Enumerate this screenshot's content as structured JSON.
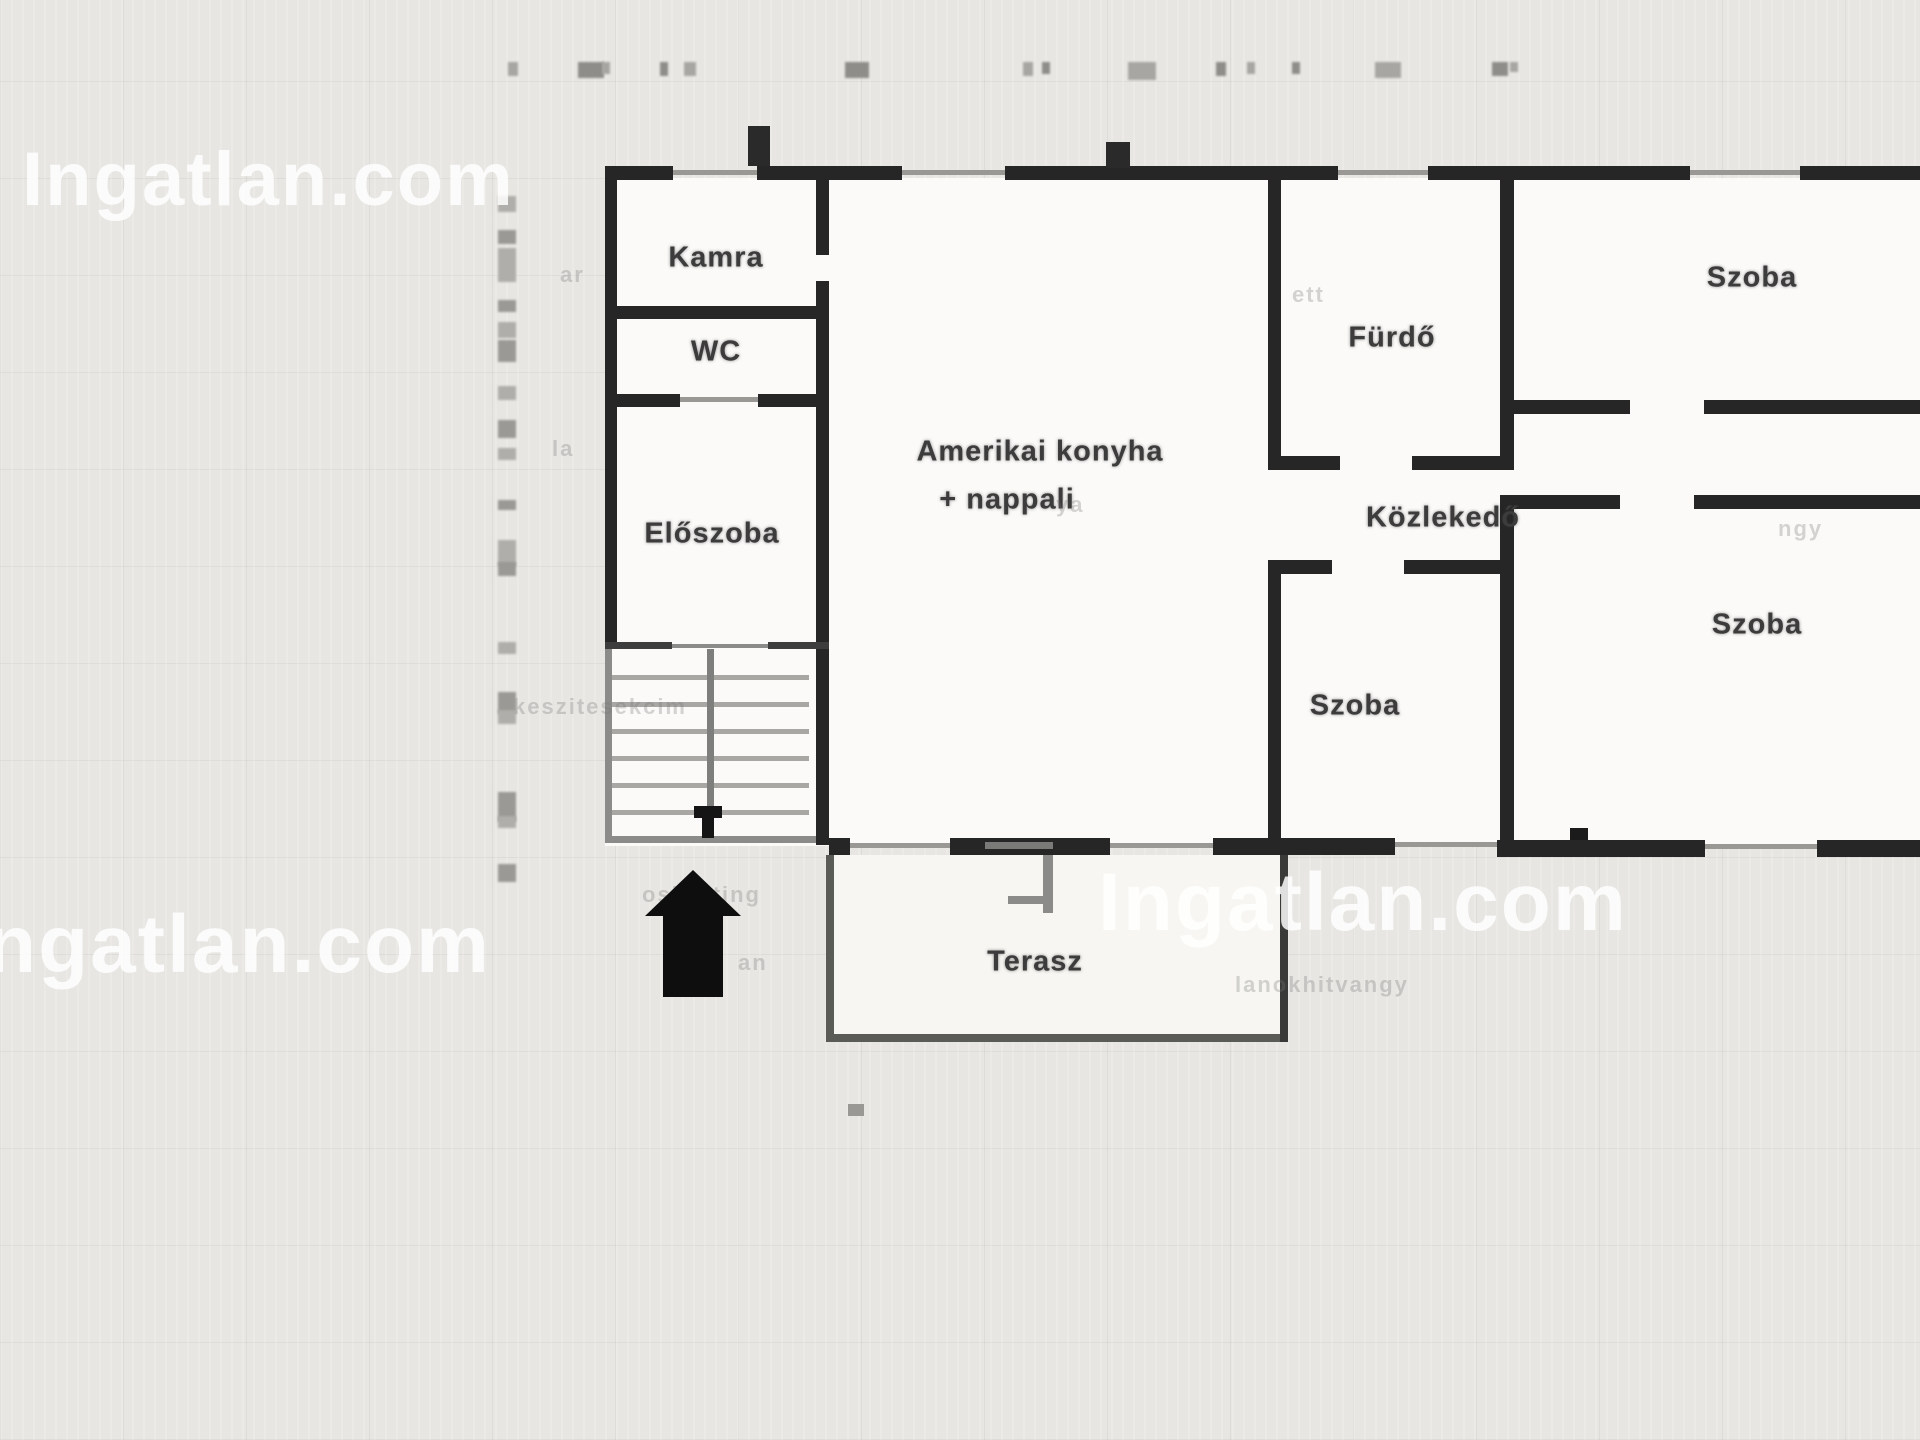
{
  "site": {
    "watermark_top_left": "Ingatlan.com",
    "watermark_bottom_left": "ngatlan.com",
    "watermark_bottom_right": "Ingatlan.com"
  },
  "floorplan": {
    "type": "residential-floor-plan",
    "language": "hu",
    "rooms": [
      {
        "id": "kamra",
        "label": "Kamra",
        "x": 716,
        "y": 258
      },
      {
        "id": "wc",
        "label": "WC",
        "x": 716,
        "y": 352
      },
      {
        "id": "eloszoba",
        "label": "Előszoba",
        "x": 712,
        "y": 534
      },
      {
        "id": "nappali-1",
        "label": "Amerikai konyha",
        "x": 1040,
        "y": 452
      },
      {
        "id": "nappali-2",
        "label": "+ nappali",
        "x": 1007,
        "y": 500
      },
      {
        "id": "furdo",
        "label": "Fürdő",
        "x": 1392,
        "y": 338
      },
      {
        "id": "szoba-top",
        "label": "Szoba",
        "x": 1752,
        "y": 278
      },
      {
        "id": "kozlekedo",
        "label": "Közlekedő",
        "x": 1443,
        "y": 518
      },
      {
        "id": "szoba-mid",
        "label": "Szoba",
        "x": 1355,
        "y": 706
      },
      {
        "id": "szoba-right",
        "label": "Szoba",
        "x": 1757,
        "y": 625
      },
      {
        "id": "terasz",
        "label": "Terasz",
        "x": 1035,
        "y": 962
      }
    ],
    "features": [
      "staircase-with-down-marker",
      "entrance-arrow",
      "window-openings",
      "door-openings"
    ]
  },
  "decor": {
    "watermark_fragments": [
      {
        "text": "ar",
        "x": 560,
        "y": 262
      },
      {
        "text": "la",
        "x": 552,
        "y": 436
      },
      {
        "text": "zkeszitesekcim",
        "x": 500,
        "y": 694
      },
      {
        "text": "ositetting",
        "x": 642,
        "y": 882
      },
      {
        "text": "an",
        "x": 738,
        "y": 950
      },
      {
        "text": "ya",
        "x": 1056,
        "y": 492
      },
      {
        "text": "ett",
        "x": 1292,
        "y": 282
      },
      {
        "text": "ngy",
        "x": 1778,
        "y": 516
      },
      {
        "text": "lanokhitvangy",
        "x": 1235,
        "y": 972
      }
    ],
    "top_dimension_marks": [
      {
        "x": 508,
        "w": 10,
        "h": 14
      },
      {
        "x": 578,
        "w": 26,
        "h": 16
      },
      {
        "x": 602,
        "w": 8,
        "h": 12
      },
      {
        "x": 660,
        "w": 8,
        "h": 14
      },
      {
        "x": 684,
        "w": 12,
        "h": 14
      },
      {
        "x": 845,
        "w": 24,
        "h": 16
      },
      {
        "x": 1023,
        "w": 10,
        "h": 14
      },
      {
        "x": 1042,
        "w": 8,
        "h": 12
      },
      {
        "x": 1128,
        "w": 28,
        "h": 18
      },
      {
        "x": 1216,
        "w": 10,
        "h": 14
      },
      {
        "x": 1247,
        "w": 8,
        "h": 12
      },
      {
        "x": 1292,
        "w": 8,
        "h": 12
      },
      {
        "x": 1375,
        "w": 26,
        "h": 16
      },
      {
        "x": 1492,
        "w": 16,
        "h": 14
      },
      {
        "x": 1510,
        "w": 8,
        "h": 10
      }
    ],
    "left_dimension_marks": [
      {
        "y": 196,
        "h": 16
      },
      {
        "y": 230,
        "h": 14
      },
      {
        "y": 248,
        "h": 34
      },
      {
        "y": 300,
        "h": 12
      },
      {
        "y": 322,
        "h": 16
      },
      {
        "y": 340,
        "h": 22
      },
      {
        "y": 386,
        "h": 14
      },
      {
        "y": 420,
        "h": 18
      },
      {
        "y": 448,
        "h": 12
      },
      {
        "y": 500,
        "h": 10
      },
      {
        "y": 540,
        "h": 26
      },
      {
        "y": 562,
        "h": 14
      },
      {
        "y": 642,
        "h": 12
      },
      {
        "y": 692,
        "h": 22
      },
      {
        "y": 710,
        "h": 14
      },
      {
        "y": 792,
        "h": 30
      },
      {
        "y": 816,
        "h": 12
      },
      {
        "y": 864,
        "h": 18
      }
    ]
  },
  "colors": {
    "background": "#e8e6e2",
    "room_fill": "#fbfaf8",
    "terrace_fill": "#f7f6f2",
    "wall": "#262626",
    "light_wall": "#5a5a57",
    "stair_line": "#a9a7a4",
    "window_line": "#9a9895",
    "label_text": "#3c3c3c",
    "watermark": "rgba(255,255,255,0.84)"
  }
}
